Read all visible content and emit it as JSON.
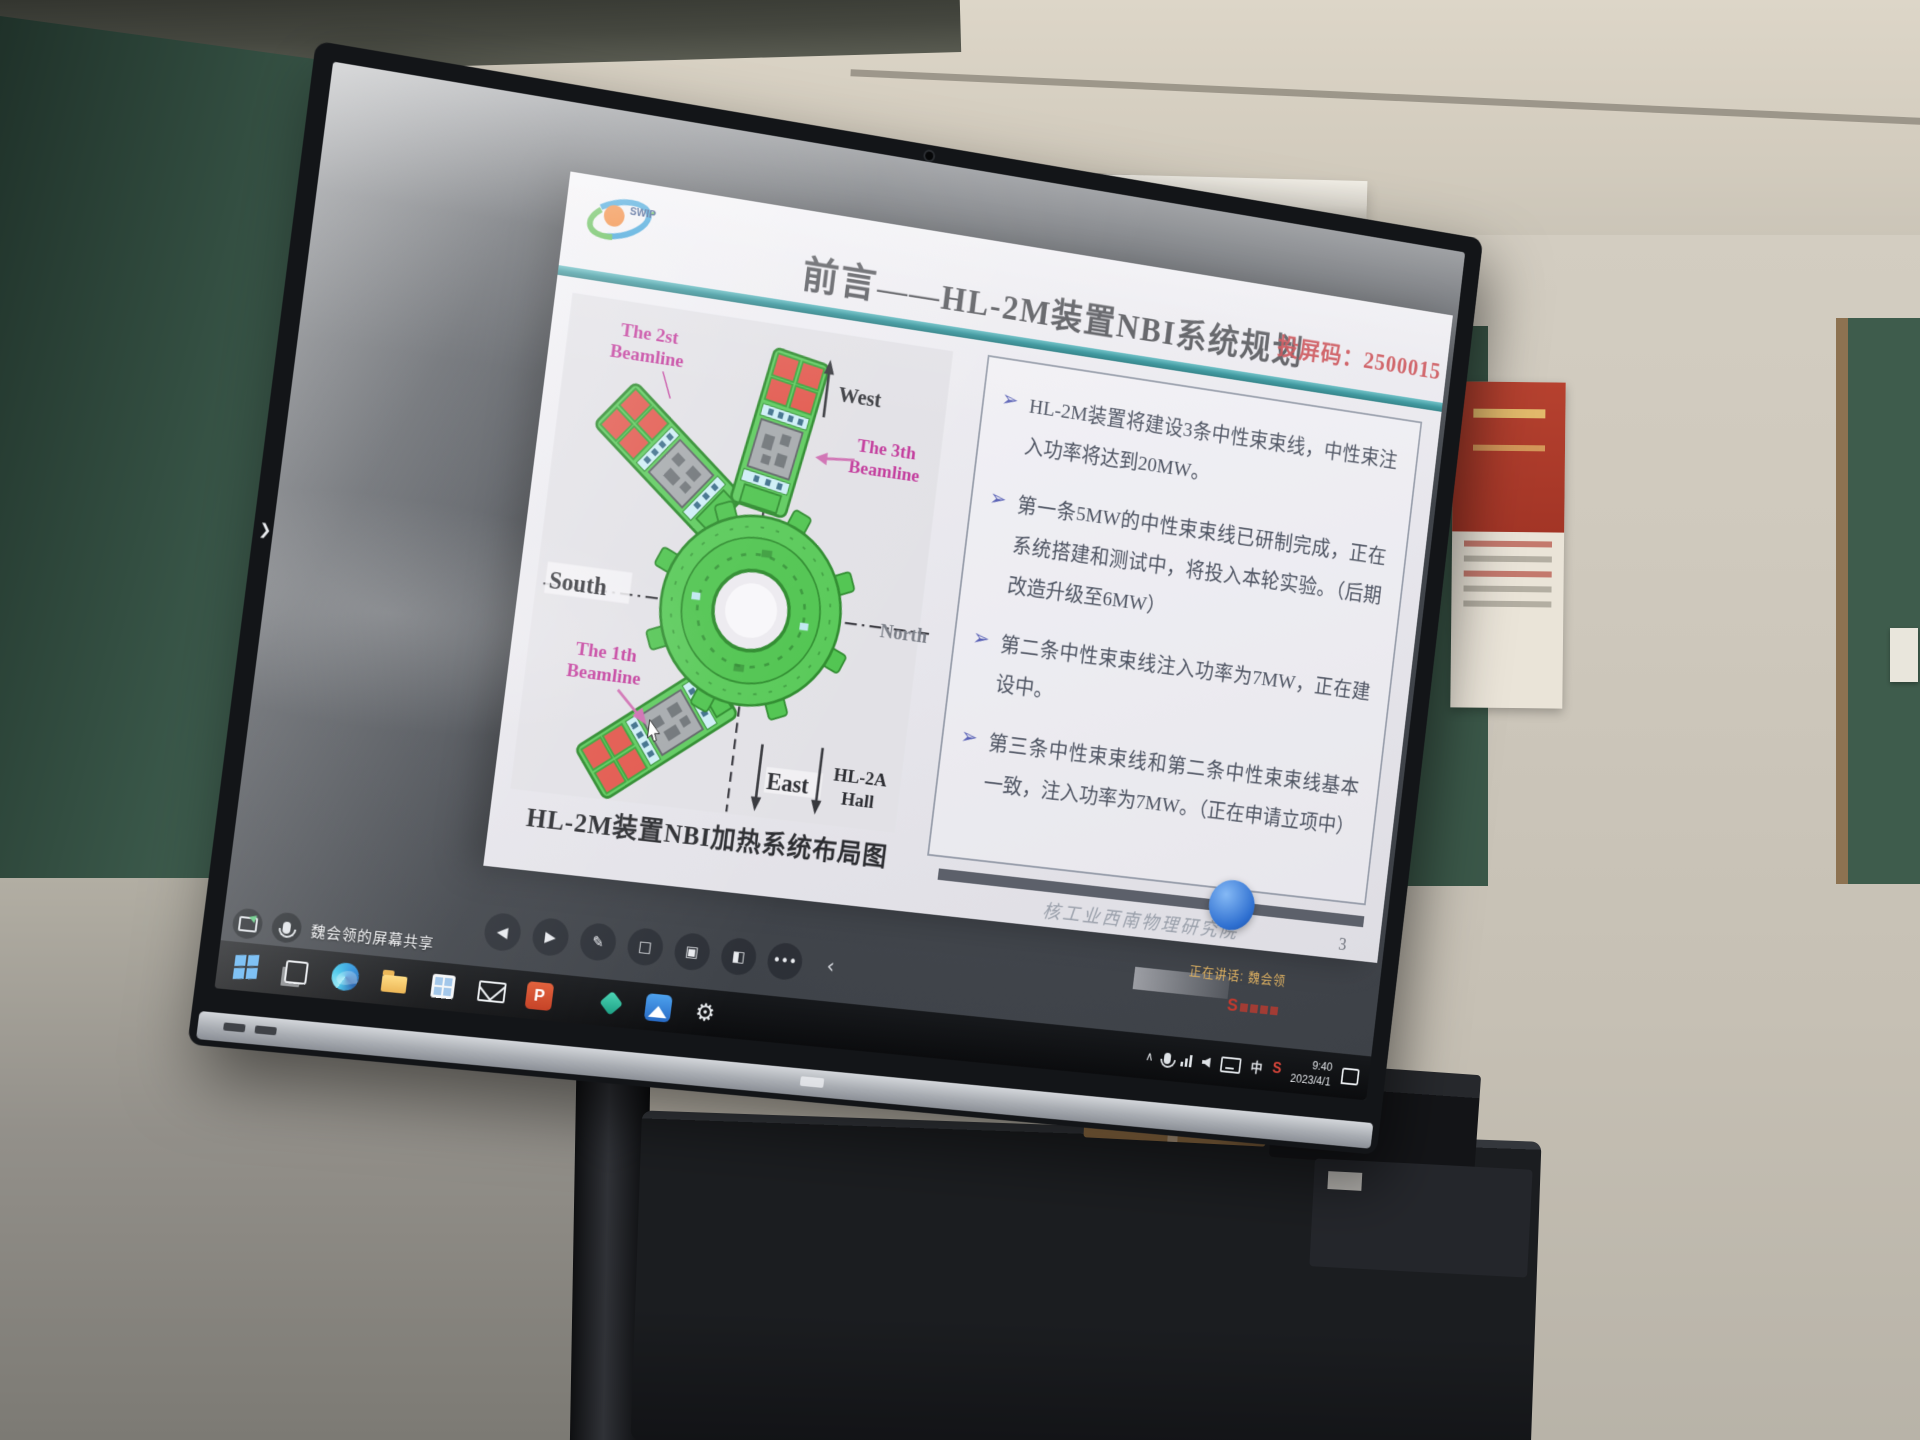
{
  "scene": {
    "share_banner": "魏会领的屏幕共享",
    "meet_watermark": "腾讯会议",
    "speaking_indicator": "正在讲话: 魏会领"
  },
  "slide": {
    "logo": "SWIP",
    "title": {
      "prefix": "前言",
      "dash": "——",
      "main": "HL-2M装置NBI系统规划"
    },
    "cast_code": "投屏码：2500015",
    "bullets": [
      "HL-2M装置将建设3条中性束束线，中性束注入功率将达到20MW。",
      "第一条5MW的中性束束线已研制完成，正在系统搭建和测试中，将投入本轮实验。（后期改造升级至6MW）",
      "第二条中性束束线注入功率为7MW，正在建设中。",
      "第三条中性束束线和第二条中性束束线基本一致，注入功率为7MW。（正在申请立项中）"
    ],
    "diagram": {
      "caption": "HL-2M装置NBI加热系统布局图",
      "labels": {
        "west": "West",
        "south": "South",
        "north": "North",
        "east": "East",
        "hall_line1": "HL-2A",
        "hall_line2": "Hall",
        "bl1_line1": "The 1th",
        "bl1_line2": "Beamline",
        "bl2_line1": "The 2st",
        "bl2_line2": "Beamline",
        "bl3_line1": "The 3th",
        "bl3_line2": "Beamline"
      }
    },
    "footer": {
      "institute": "核工业西南物理研究院",
      "page": "3"
    }
  },
  "toolbar": {
    "glyphs": [
      "◀",
      "▶",
      "✎",
      "□",
      "▣",
      "◧",
      "•••",
      "‹"
    ]
  },
  "taskbar": {
    "ppt_letter": "P",
    "settings_glyph": "⚙",
    "tray": {
      "chevron": "∧",
      "ime": "中",
      "brand": "S",
      "time": "9:40",
      "date": "2023/4/1"
    }
  },
  "colors": {
    "teal_accent": "#2f9097",
    "cast_red": "#c9474d",
    "beamline_magenta": "#c2399b",
    "diagram_green": "#4fc44f",
    "panel_red": "#e2574c",
    "bullet_blue": "#5961b6"
  }
}
